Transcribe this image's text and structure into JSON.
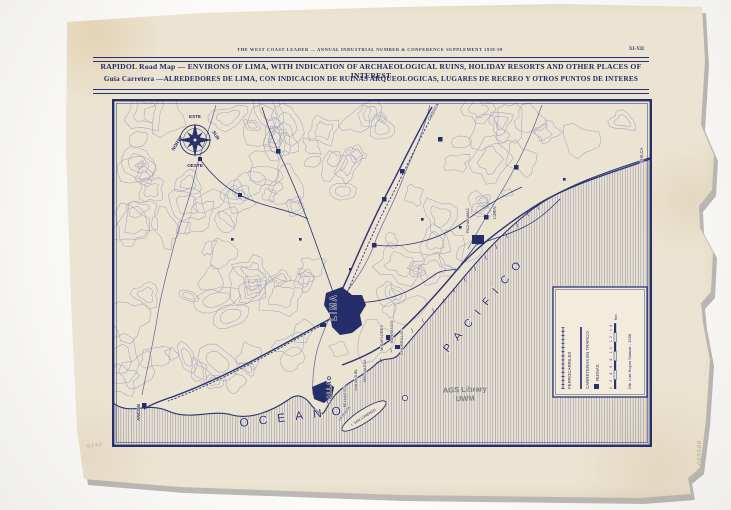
{
  "colors": {
    "ink": "#29316e",
    "contour": "#8f98bd",
    "paper": "#ece4d2",
    "river": "#5a64a0",
    "stamp": "#70707a"
  },
  "header": {
    "masthead": "THE WEST COAST LEADER — ANNUAL INDUSTRIAL NUMBER & CONFERENCE SUPPLEMENT 1938-39",
    "page_ref": "XI-XII",
    "title_en": "RAPIDOL Road Map — ENVIRONS OF LIMA, WITH INDICATION OF ARCHAEOLOGICAL RUINS, HOLIDAY RESORTS AND OTHER PLACES OF INTEREST",
    "title_es": "Guía Carretera —ALREDEDORES DE LIMA, CON INDICACION DE RUINAS ARQUEOLOGICAS, LUGARES DE RECREO Y OTROS PUNTOS DE INTERES"
  },
  "map": {
    "compass": {
      "north": "NORTE",
      "south": "SUR",
      "east": "ESTE",
      "west": "OESTE"
    },
    "ocean_word_1": "OCEANO",
    "ocean_word_2": "PACIFICO",
    "stamp_line_1": "AGS Library",
    "stamp_line_2": "UWM",
    "legend": {
      "items": [
        {
          "label": "FERROCARRILES",
          "symbol": "railway-line"
        },
        {
          "label": "CARRETERAS EN TRAFICO",
          "symbol": "road-line"
        },
        {
          "label": "RUINAS",
          "symbol": "ruins-square"
        }
      ],
      "scale_ticks": "0 2 4 6 8 10 12 14",
      "scale_unit": "Km.",
      "credit": "Dib. Luis Hoyos Salazar - 1938"
    },
    "places": [
      {
        "label": "LIMA",
        "x": 224,
        "y": 222,
        "rot": -90,
        "size": 8,
        "bold": true,
        "ls": 2
      },
      {
        "label": "CALLAO",
        "x": 219,
        "y": 305,
        "rot": -90,
        "size": 5.5,
        "bold": true,
        "ls": 1
      },
      {
        "label": "LA PUNTA",
        "x": 228,
        "y": 322,
        "rot": -52,
        "size": 3.6
      },
      {
        "label": "BELLAVISTA",
        "x": 234,
        "y": 308,
        "rot": -90,
        "size": 3.6
      },
      {
        "label": "SAN MIGUEL",
        "x": 245,
        "y": 292,
        "rot": -90,
        "size": 3.6
      },
      {
        "label": "MAGDALENA",
        "x": 254,
        "y": 283,
        "rot": -90,
        "size": 3.6
      },
      {
        "label": "MIRAFLORES",
        "x": 271,
        "y": 252,
        "rot": -90,
        "size": 4
      },
      {
        "label": "BARRANCO",
        "x": 281,
        "y": 244,
        "rot": -90,
        "size": 4
      },
      {
        "label": "CHORRILLOS",
        "x": 291,
        "y": 256,
        "rot": -90,
        "size": 4
      },
      {
        "label": "ANCON",
        "x": 28,
        "y": 322,
        "rot": -90,
        "size": 4.6,
        "bold": true
      },
      {
        "label": "CHOSICA",
        "x": 318,
        "y": 22,
        "rot": -62,
        "size": 4.2
      },
      {
        "label": "CHILCA",
        "x": 531,
        "y": 64,
        "rot": -90,
        "size": 4.2
      },
      {
        "label": "PACHACAMAC",
        "x": 357,
        "y": 134,
        "rot": -90,
        "size": 3.6
      },
      {
        "label": "LURIN",
        "x": 384,
        "y": 120,
        "rot": -90,
        "size": 4.2
      },
      {
        "label": "I. SAN LORENZO",
        "x": 240,
        "y": 327,
        "rot": -33,
        "size": 3.6
      }
    ]
  },
  "annotations": {
    "pencil_right": "Serie 6-005506",
    "pencil_corner": "9140"
  }
}
